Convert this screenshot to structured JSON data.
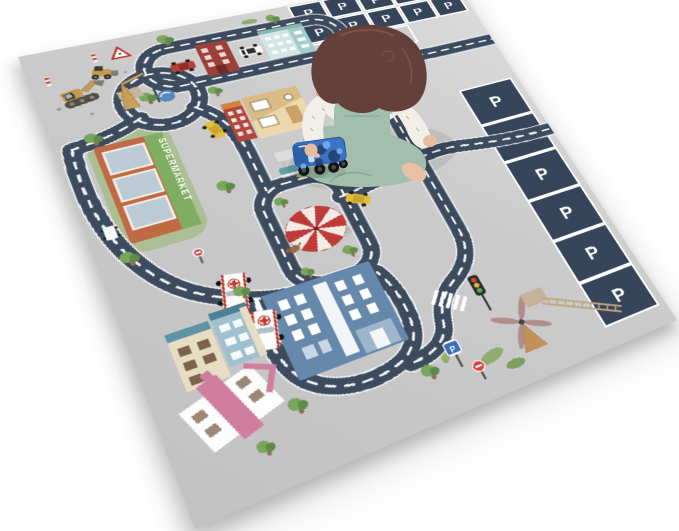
{
  "scene": {
    "background_color": "#ffffff",
    "objects": [
      "toddler",
      "toy-truck",
      "road-play-mat",
      "roundabout",
      "circus-tent",
      "supermarket",
      "hospital",
      "ambulances",
      "construction-vehicles",
      "windmill",
      "traffic-light",
      "parking-areas",
      "houses",
      "taxis",
      "police-car",
      "trees"
    ]
  },
  "mat": {
    "parking_letter": "P",
    "supermarket_sign_text": "SUPERMARKET",
    "top_parking_dark_spaces": 10,
    "top_parking_light_spaces": 3,
    "right_parking_spaces": 6,
    "colors": {
      "mat_gray": "#cbcbcc",
      "road": "#3d4b5f",
      "road_marking": "#ffffff",
      "parking_square": "#36455a",
      "supermarket_orange": "#c06a45",
      "supermarket_sign_green": "#7fae62",
      "hospital_blue": "#6688ab",
      "ambulance_red": "#c0392b",
      "tent_red": "#c23a37",
      "pink_roof": "#cf7f9d",
      "taxi_yellow": "#e2bf3e",
      "grass_green": "#a9bd8d",
      "tree_green": "#5f8c49",
      "pond_blue": "#5588c0",
      "windmill_tan": "#c29158"
    }
  },
  "child": {
    "colors": {
      "hair": "#63413a",
      "skin": "#eabc9f",
      "shirt": "#f2efe9",
      "overalls": "#a2bfae",
      "toy_truck": "#3b72c4"
    }
  }
}
